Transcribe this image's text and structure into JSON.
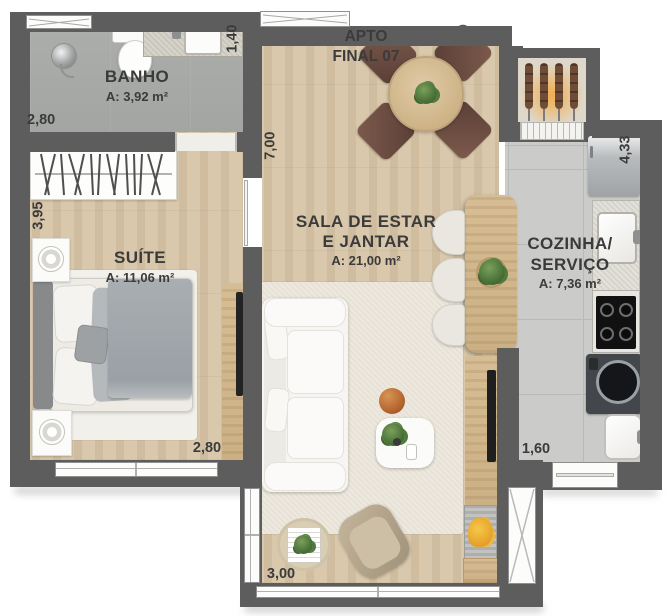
{
  "title": {
    "line1": "APTO",
    "line2": "FINAL 07"
  },
  "rooms": {
    "bathroom": {
      "name": "BANHO",
      "area": "A: 3,92 m²"
    },
    "suite": {
      "name": "SUÍTE",
      "area": "A: 11,06 m²"
    },
    "living": {
      "name_line1": "SALA DE ESTAR",
      "name_line2": "E JANTAR",
      "area": "A: 21,00 m²"
    },
    "kitchen": {
      "name_line1": "COZINHA/",
      "name_line2": "SERVIÇO",
      "area": "A: 7,36 m²"
    }
  },
  "dimensions": {
    "bathroom_width": "2,80",
    "bathroom_depth": "1,40",
    "suite_depth": "3,95",
    "suite_width": "2,80",
    "living_depth": "7,00",
    "kitchen_depth": "4,33",
    "kitchen_width": "1,60",
    "living_width": "3,00"
  },
  "colors": {
    "wall": "#5d5d5d",
    "wood_floor": "#d9c8ab",
    "kitchen_floor": "#cbccca",
    "bathroom_floor": "#a7a9a6",
    "rug": "#e7e2d5",
    "label_text": "#3b3b3b",
    "plant_green": "#4e7a3c",
    "chair_brown": "#74514a",
    "flame_orange": "#e9a23b"
  }
}
